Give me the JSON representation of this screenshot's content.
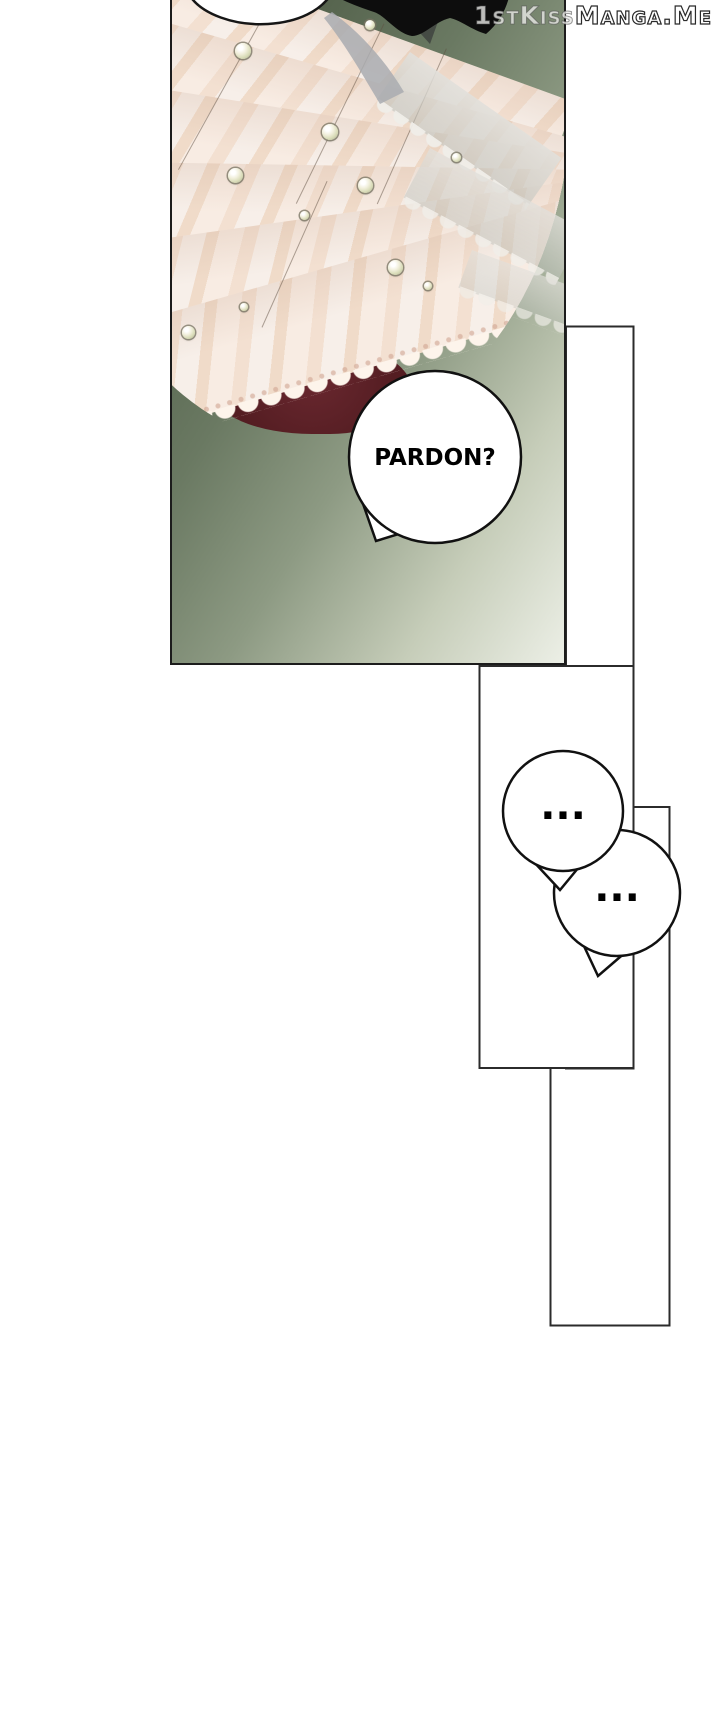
{
  "watermark": {
    "text": "1stKissManga.Me",
    "part1": "1stKiss",
    "part2": "Manga.Me"
  },
  "comic": {
    "main_panel": {
      "description": "close-up of a cream layered lace dress with pearls on a green gradient background",
      "dialogue_bubble": {
        "text": "PARDON?"
      }
    },
    "thought_bubble_1": {
      "text": "..."
    },
    "thought_bubble_2": {
      "text": "..."
    }
  },
  "colors": {
    "page_background": "#ffffff",
    "panel_gradient_dark": "#404e3b",
    "panel_gradient_light": "#ecefe6",
    "dress_cream": "#f8ece3",
    "dress_blush": "#f0dbc9",
    "lace_white": "#fdf4eb",
    "maroon_lining": "#541d22",
    "hair_black": "#0d0d0d",
    "outline_black": "#1c1c1c",
    "bubble_fill": "#ffffff"
  }
}
